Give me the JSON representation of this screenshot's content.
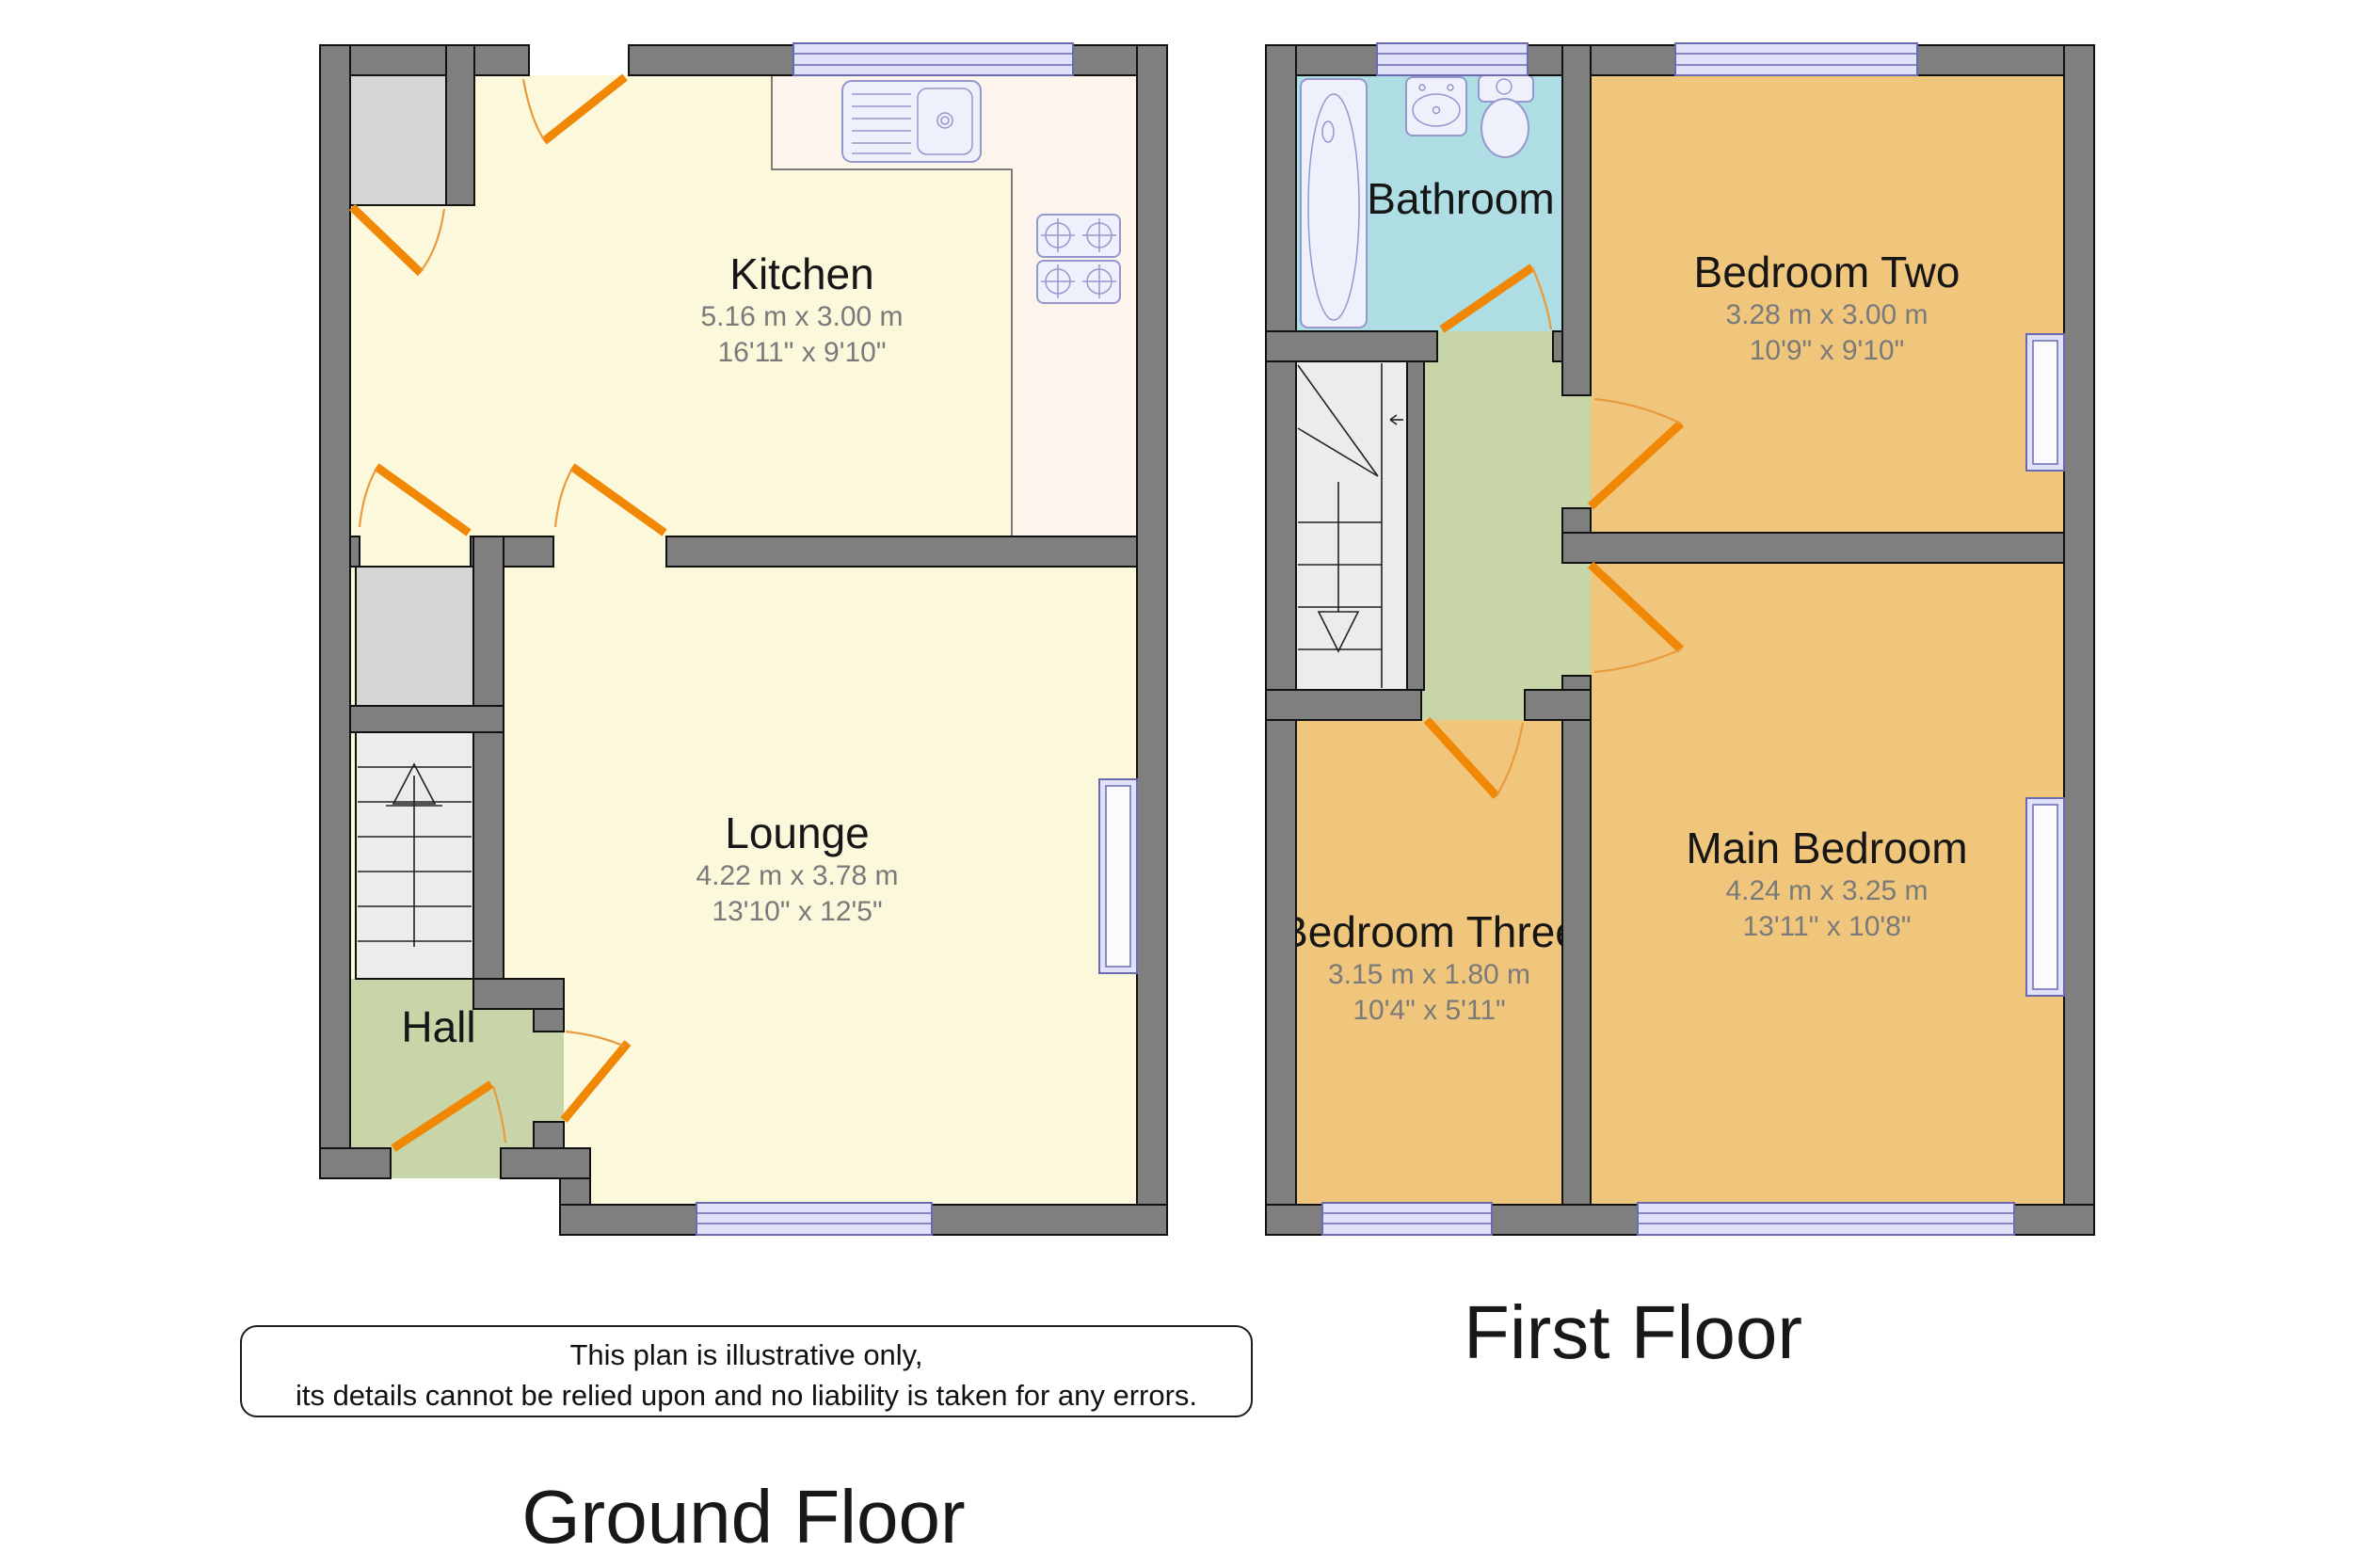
{
  "ground_floor": {
    "title": "Ground Floor",
    "rooms": {
      "kitchen": {
        "name": "Kitchen",
        "metric": "5.16 m x 3.00 m",
        "imperial": "16'11\" x 9'10\""
      },
      "lounge": {
        "name": "Lounge",
        "metric": "4.22 m x 3.78 m",
        "imperial": "13'10\" x 12'5\""
      },
      "hall": {
        "name": "Hall"
      }
    }
  },
  "first_floor": {
    "title": "First Floor",
    "rooms": {
      "bathroom": {
        "name": "Bathroom"
      },
      "bedroom_two": {
        "name": "Bedroom Two",
        "metric": "3.28 m x 3.00 m",
        "imperial": "10'9\" x 9'10\""
      },
      "main_bedroom": {
        "name": "Main Bedroom",
        "metric": "4.24 m x 3.25 m",
        "imperial": "13'11\" x 10'8\""
      },
      "bedroom_three": {
        "name": "Bedroom Three",
        "metric": "3.15 m x 1.80 m",
        "imperial": "10'4\" x 5'11\""
      }
    }
  },
  "disclaimer": {
    "line1": "This plan is illustrative only,",
    "line2": "its details cannot be relied upon and no liability is taken for any errors."
  },
  "icons": {
    "fixtures": [
      "bath-icon",
      "basin-icon",
      "toilet-icon",
      "sink-icon",
      "hob-icon",
      "stairs-up-icon",
      "stairs-down-icon",
      "door-swing-icon",
      "window-icon"
    ]
  },
  "colors": {
    "wall": "#7f7f7f",
    "floor_living": "#fcf8dc",
    "floor_counter": "#fdf4ec",
    "floor_bedroom": "#f0c67c",
    "floor_bathroom": "#aedde3",
    "floor_hall": "#c8d5a9",
    "floor_closet": "#d5d5d5",
    "floor_stairs": "#ececec",
    "window_fill": "#dfe2f8",
    "window_stroke": "#6a6ab0",
    "fixture_fill": "#eef0fb",
    "fixture_stroke": "#9597cf",
    "door": "#f08705",
    "door_arc": "#e89b3f",
    "text_dark": "#161616",
    "text_dim": "#7a7a7a"
  }
}
